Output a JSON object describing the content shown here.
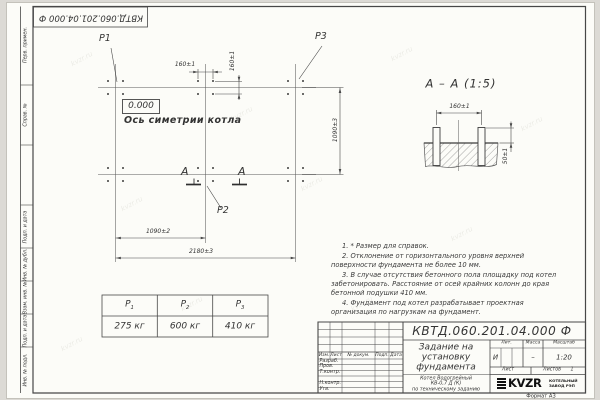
{
  "colors": {
    "line": "#474747",
    "text": "#333333",
    "sheet": "#fcfcf8",
    "background": "#dcdad5"
  },
  "stamp_number": "КВТД.060.201.04.000  Ф",
  "watermark": "kvzr.ru",
  "margin_labels": [
    "Перв. примен.",
    "Справ. №",
    "Подп. и дата",
    "Инв. № дубл.",
    "Взам. инв. №",
    "Подп. и дата",
    "Инв. № подл."
  ],
  "plan": {
    "p1": "P1",
    "p2": "P2",
    "p3": "P3",
    "level": "0.000",
    "axis": "Ось симетрии котла",
    "dim_160_h": "160±1",
    "dim_160_v": "160±1",
    "dim_1090_right": "1090±3",
    "dim_1090_bottom": "1090±2",
    "dim_2180": "2180±3",
    "section_letter": "А"
  },
  "section": {
    "title": "А – А (1:5)",
    "dim_160": "160±1",
    "dim_50": "50±1"
  },
  "loads_table": {
    "headers": [
      {
        "sym": "P",
        "sub": "1"
      },
      {
        "sym": "P",
        "sub": "2"
      },
      {
        "sym": "P",
        "sub": "3"
      }
    ],
    "values": [
      "275 кг",
      "600 кг",
      "410 кг"
    ]
  },
  "notes": [
    "1. * Размер для справок.",
    "2. Отклонение от горизонтального уровня верхней поверхности фундамента не более 10 мм.",
    "3. В случае отсутствия бетонного пола площадку под котел забетонировать. Расстояние от осей крайних колонн до края бетонной подушки 410 мм.",
    "4. Фундамент под котел разрабатывает проектная организация по нагрузкам на фундамент."
  ],
  "title_block": {
    "number": "КВТД.060.201.04.000  Ф",
    "rev_header": {
      "izm": "Изм.",
      "list": "Лист",
      "doc": "№ докум.",
      "sign": "Подп.",
      "date": "Дата"
    },
    "roles": [
      "Разраб.",
      "Пров.",
      "Т.контр.",
      "",
      "Н.контр.",
      "Утв."
    ],
    "title": [
      "Задание на",
      "установку",
      "фундамента"
    ],
    "subtitle": [
      "Котел Водогрейный",
      "КВ-0,7 Д (К)",
      "по техническому заданию"
    ],
    "lit_label": "Лит.",
    "lit": "И",
    "mass_label": "Масса",
    "mass": "–",
    "scale_label": "Масштаб",
    "scale": "1:20",
    "sheet_label": "Лист",
    "sheets_label": "Листов",
    "sheets": "1",
    "logo": "KVZR",
    "logo_caption": [
      "КОТЕЛЬНЫЙ",
      "ЗАВОД РЭП"
    ],
    "format": "Формат А3"
  }
}
